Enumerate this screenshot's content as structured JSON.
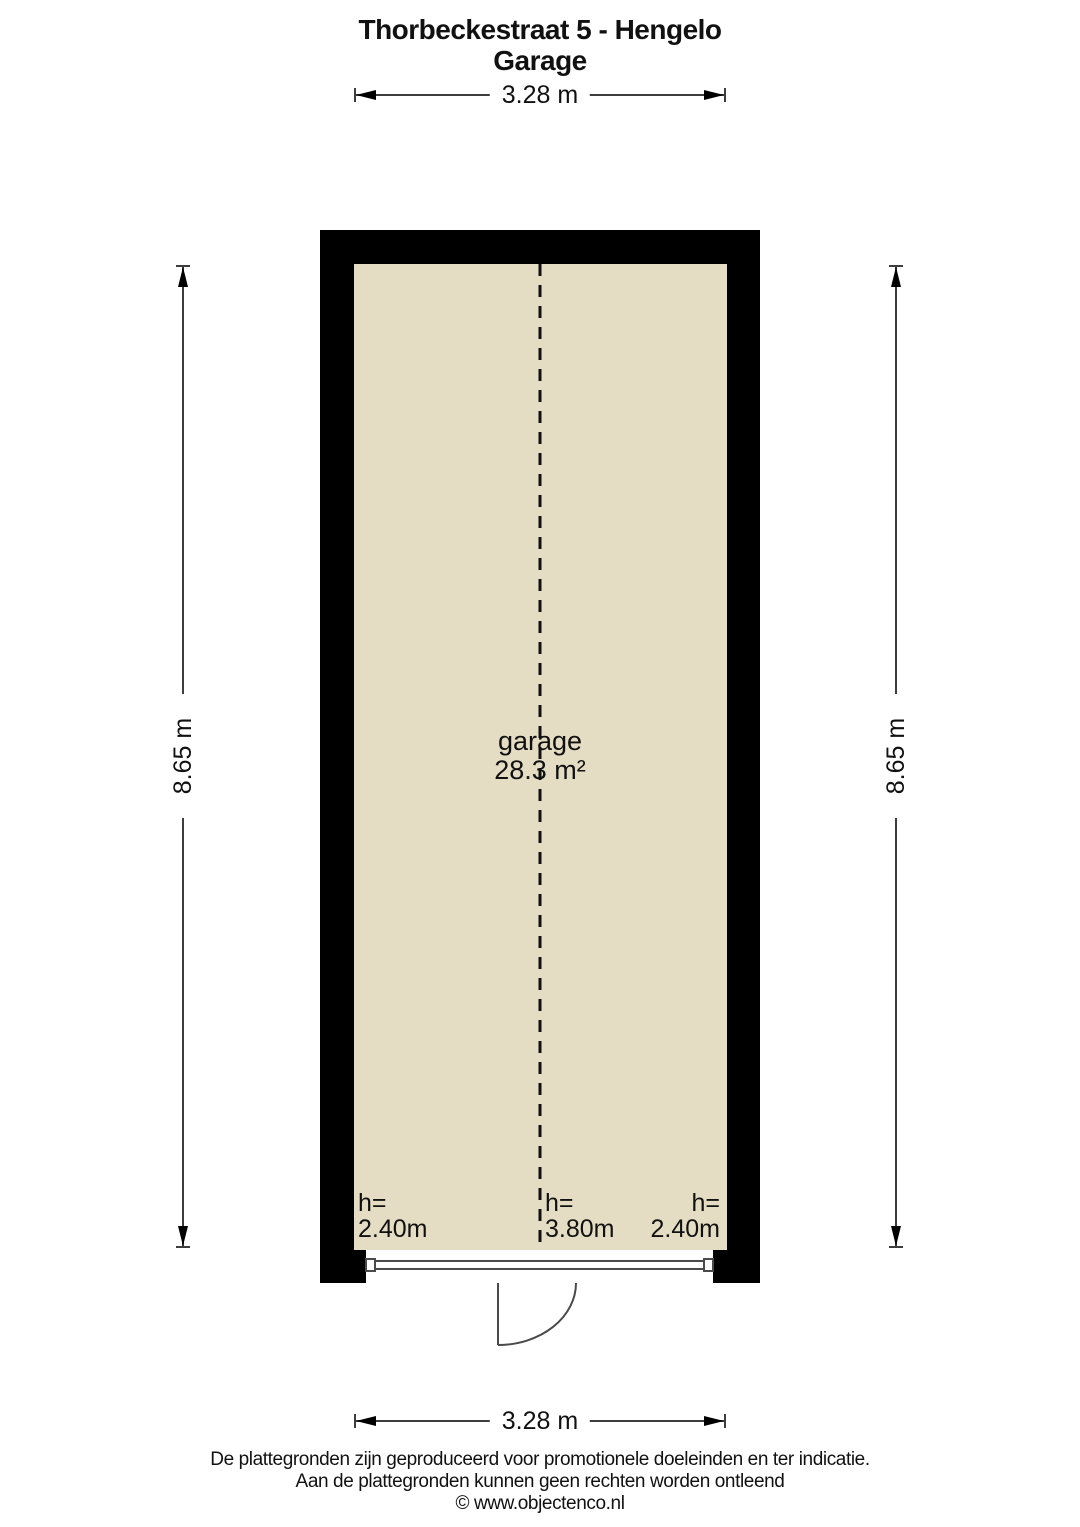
{
  "title": {
    "line1": "Thorbeckestraat 5 - Hengelo",
    "line2": "Garage"
  },
  "room": {
    "name": "garage",
    "area": "28.3 m²"
  },
  "dimensions": {
    "top": "3.28 m",
    "bottom": "3.28 m",
    "left": "8.65 m",
    "right": "8.65 m"
  },
  "ceiling_heights": [
    {
      "label": "h=",
      "value": "2.40m"
    },
    {
      "label": "h=",
      "value": "3.80m"
    },
    {
      "label": "h=",
      "value": "2.40m"
    }
  ],
  "footer": {
    "line1": "De plattegronden zijn geproduceerd voor promotionele doeleinden en ter indicatie.",
    "line2": "Aan de plattegronden kunnen geen rechten worden ontleend",
    "line3": "© www.objectenco.nl"
  },
  "colors": {
    "floor": "#e4dcc3",
    "wall": "#000000",
    "dimension_line": "#3d3d3d",
    "door_line": "#4a4a4a",
    "background": "#ffffff"
  }
}
